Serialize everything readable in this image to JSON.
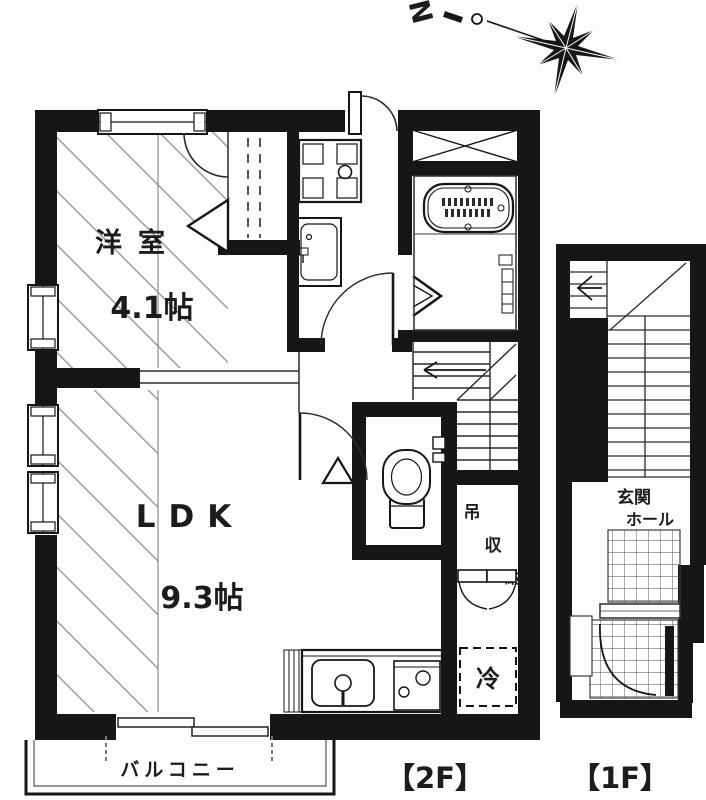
{
  "compass": {
    "north": "N"
  },
  "floor_2f": {
    "floor_label": "【2F】",
    "western_room_name": "洋室",
    "western_room_area": "4.1帖",
    "ldk_name": "LDK",
    "ldk_area": "9.3帖",
    "balcony_label": "バルコニー",
    "hanging_storage_char1": "吊",
    "hanging_storage_char2": "収",
    "hanging_storage_char3": "納",
    "refrigerator_label": "冷"
  },
  "floor_1f": {
    "floor_label": "【1F】",
    "entrance_hall_line1": "玄関",
    "entrance_hall_line2": "ホール"
  },
  "colors": {
    "wall": "#161616",
    "line": "#2b2b2b",
    "hatch": "#8f8f8f",
    "background": "#fdfdfd",
    "muted_text": "#454545"
  }
}
